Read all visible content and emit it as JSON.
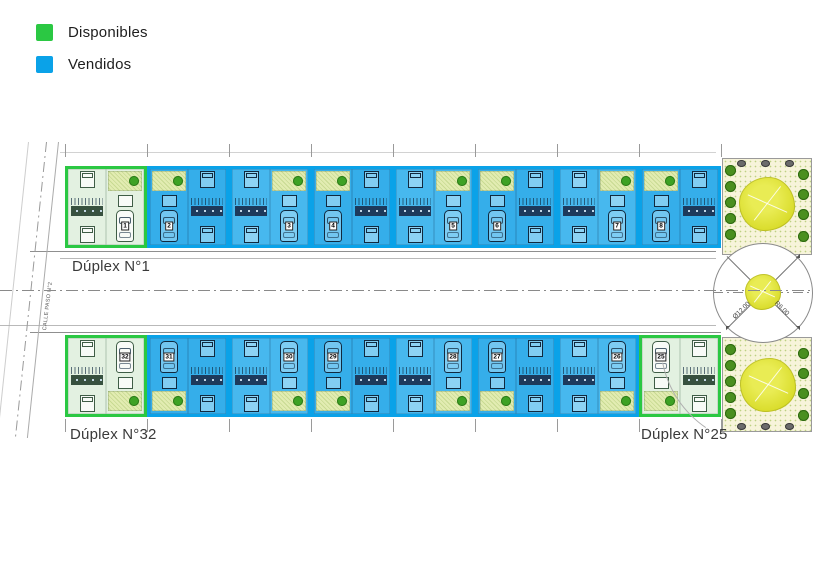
{
  "legend": {
    "items": [
      {
        "id": "available",
        "label": "Disponibles",
        "color": "#2bc843"
      },
      {
        "id": "sold",
        "label": "Vendidos",
        "color": "#0aa2e8"
      }
    ]
  },
  "plan": {
    "street_label": "CALLE PASO N°2",
    "unit_labels": {
      "top_left": "Dúplex N°1",
      "bottom_left": "Dúplex N°32",
      "bottom_right": "Dúplex N°25"
    },
    "roundabout": {
      "diameter_label": "Ø12.00",
      "radius_label": "R6.00"
    },
    "rows": {
      "top": [
        {
          "number": "1",
          "status": "available"
        },
        {
          "number": "2",
          "status": "sold"
        },
        {
          "number": "3",
          "status": "sold"
        },
        {
          "number": "4",
          "status": "sold"
        },
        {
          "number": "5",
          "status": "sold"
        },
        {
          "number": "6",
          "status": "sold"
        },
        {
          "number": "7",
          "status": "sold"
        },
        {
          "number": "8",
          "status": "sold"
        }
      ],
      "bottom": [
        {
          "number": "32",
          "status": "available"
        },
        {
          "number": "31",
          "status": "sold"
        },
        {
          "number": "30",
          "status": "sold"
        },
        {
          "number": "29",
          "status": "sold"
        },
        {
          "number": "28",
          "status": "sold"
        },
        {
          "number": "27",
          "status": "sold"
        },
        {
          "number": "26",
          "status": "sold"
        },
        {
          "number": "25",
          "status": "available"
        }
      ]
    }
  },
  "colors": {
    "available": "#2bc843",
    "sold": "#0aa2e8",
    "available_fill": "#e3f1e1",
    "sold_fill": "#47b8ee",
    "sold_fill_alt": "#35aeea"
  }
}
